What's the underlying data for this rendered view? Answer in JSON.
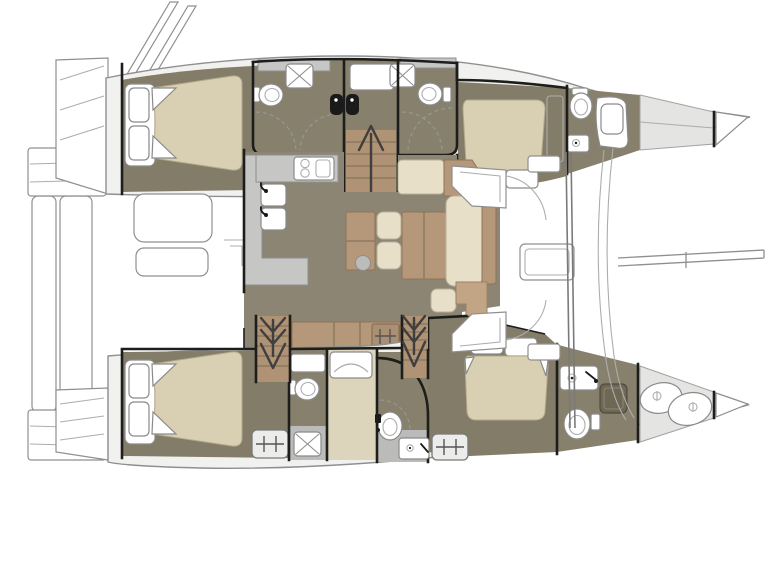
{
  "document": {
    "kind": "yacht-floor-plan",
    "vessel_type": "sailing-catamaran",
    "view": "top-down-deck-plan",
    "orientation": {
      "bow": "right",
      "stern": "left"
    }
  },
  "colors": {
    "background": "#ffffff",
    "outline": "#8f8f8f",
    "deck": "#f1f1ef",
    "wall": "#1d1d1b",
    "floor_cabin": "#837c68",
    "floor_head": "#87806c",
    "floor_saloon": "#8d8574",
    "floor_grey": "#bbbbb9",
    "mattress": "#d9cfb2",
    "cushion": "#e7dfc7",
    "wood": "#b5977a",
    "wood_light": "#c2a584",
    "wood_step": "#b09274",
    "counter": "#c6c6c4",
    "fixture_white": "#ffffff",
    "fixture_black": "#1a1a1a",
    "forepeak": "#e4e4e2",
    "hatch": "#ececea",
    "shower_dark": "#6e6754",
    "cream_floor": "#dcd4bb",
    "arrow": "#3f3f3f"
  },
  "plan": {
    "hull_top": {
      "rooms": [
        "aft-cabin",
        "aft-head",
        "companionway",
        "fwd-head",
        "fwd-cabin",
        "bow-head",
        "forepeak",
        "bow-locker"
      ]
    },
    "hull_bottom": {
      "rooms": [
        "aft-cabin",
        "aft-head",
        "corridor-berth",
        "fwd-head",
        "fwd-cabin",
        "bow-head",
        "forepeak",
        "bow-locker"
      ]
    },
    "bridgedeck": {
      "rooms": [
        "aft-cockpit",
        "swim-platform",
        "saloon",
        "galley",
        "dinette",
        "fwd-cockpit",
        "trampoline",
        "bowsprit"
      ]
    },
    "fixture_counts": {
      "double_beds": 4,
      "toilets": 6,
      "showers": 4,
      "black_basins": 2,
      "galley_sinks": 2,
      "stove_burners": 2,
      "vanity_sinks": 4,
      "escape_hatches": 2,
      "companionway_arrows": 3,
      "cockpit_seats": 2,
      "forepeak_gear_bags": 2
    }
  }
}
